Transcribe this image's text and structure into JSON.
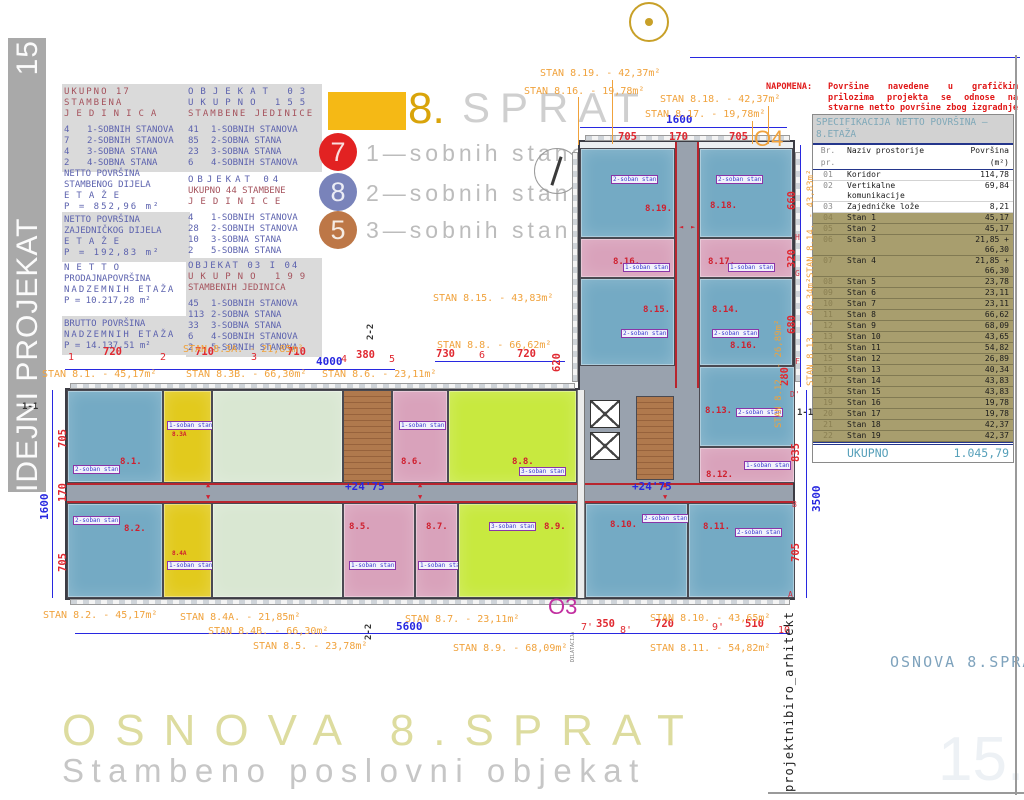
{
  "sidebar": {
    "number": "15",
    "label": "IDEJNI PROJEKAT"
  },
  "colors": {
    "apartment_blue": "#74aac4",
    "apartment_yellow": "#e2ca1d",
    "apartment_green": "#d9e7d2",
    "apartment_lime": "#c8e93f",
    "apartment_pink": "#d9a2bb",
    "stairs_brown": "#b0794d",
    "corridor_gray": "#99a2ae",
    "wall_red": "#b8252e",
    "legend_orange": "#f5b915",
    "legend_red": "#e22222",
    "legend_blue": "#7983ba",
    "legend_brown": "#bd7747",
    "label_orange": "#f0a23c",
    "dim_red": "#e02830",
    "dim_blue": "#2828e0",
    "table_olive": "#a89e6e",
    "note_red": "#e01818",
    "o3_magenta": "#c22fa0",
    "title_pale_yellow": "#dddc9f",
    "sidebar_gray": "#a9a9a9"
  },
  "stats": {
    "total": {
      "title": [
        "UKUPNO 17 STAMBENA",
        "JEDINICA"
      ],
      "items": [
        [
          "4",
          "1-SOBNIH STANOVA"
        ],
        [
          "7",
          "2-SOBNIH STANOVA"
        ],
        [
          "4",
          "3-SOBNA STANA"
        ],
        [
          "2",
          "4-SOBNA STANA"
        ]
      ]
    },
    "areas": [
      {
        "lines": [
          "NETTO POVRŠINA",
          "STAMBENOG DIJELA",
          "ETAŽE",
          "P = 852,96 m²"
        ]
      },
      {
        "lines": [
          "NETTO POVRŠINA",
          "ZAJEDNIČKOG DIJELA",
          "ETAŽE",
          "P = 192,83 m²"
        ]
      },
      {
        "lines": [
          "NETTO",
          "PRODAJNAPOVRŠINA",
          "NADZEMNIH ETAŽA",
          "P = 10.217,28 m²"
        ]
      },
      {
        "lines": [
          "BRUTTO POVRŠINA",
          "NADZEMNIH ETAŽA",
          "P = 14.137,51 m²"
        ]
      }
    ],
    "objects": [
      {
        "header": [
          "OBJEKAT 03",
          "UKUPNO 155",
          "STAMBENE JEDINICE"
        ],
        "items": [
          [
            "41",
            "1-SOBNIH STANOVA"
          ],
          [
            "85",
            "2-SOBNA STANA"
          ],
          [
            "23",
            "3-SOBNA STANA"
          ],
          [
            "6",
            "4-SOBNIH STANOVA"
          ]
        ]
      },
      {
        "header": [
          "OBJEKAT 04",
          "UKUPNO 44 STAMBENE",
          "JEDINICE"
        ],
        "items": [
          [
            "4",
            "1-SOBNIH STANOVA"
          ],
          [
            "28",
            "2-SOBNIH STANOVA"
          ],
          [
            "10",
            "3-SOBNA STANA"
          ],
          [
            "2",
            "5-SOBNA STANA"
          ]
        ]
      },
      {
        "header": [
          "OBJEKAT 03 I 04",
          "UKUPNO 199",
          "STAMBENIH JEDINICA"
        ],
        "items": [
          [
            "45",
            "1-SOBNIH STANOVA"
          ],
          [
            "113",
            "2-SOBNA STANA"
          ],
          [
            "33",
            "3-SOBNA STANA"
          ],
          [
            "6",
            "4-SOBNIH STANOVA"
          ],
          [
            "2",
            "5-SOBNIH STANOVA"
          ]
        ]
      }
    ]
  },
  "legend": {
    "floor_number": "8.",
    "floor_word": "SPRAT",
    "entries": [
      {
        "count": "7",
        "label": "1—sobnih stanova",
        "color": "#e22222"
      },
      {
        "count": "8",
        "label": "2—sobnih stanova",
        "color": "#7983ba"
      },
      {
        "count": "5",
        "label": "3—sobnih stanova",
        "color": "#bd7747"
      }
    ]
  },
  "napomena": {
    "label": "NAPOMENA:",
    "text": "Površine navedene u grafičkim prilozima projekta se odnose na stvarne netto površine zbog izgradnje objekta."
  },
  "spec_table": {
    "title_line1": "SPECIFIKACIJA NETTO POVRŠINA —",
    "title_line2": "8.ETAŽA",
    "columns": [
      "Br. pr.",
      "Naziv prostorije",
      "Površina (m²)"
    ],
    "rows": [
      [
        "01",
        "Koridor",
        "114,78"
      ],
      [
        "02",
        "Vertikalne komunikacije",
        "69,84"
      ],
      [
        "03",
        "Zajedničke lože",
        "8,21"
      ],
      [
        "04",
        "Stan 1",
        "45,17"
      ],
      [
        "05",
        "Stan 2",
        "45,17"
      ],
      [
        "06",
        "Stan 3",
        "21,85 + 66,30"
      ],
      [
        "07",
        "Stan 4",
        "21,85 + 66,30"
      ],
      [
        "08",
        "Stan 5",
        "23,78"
      ],
      [
        "09",
        "Stan 6",
        "23,11"
      ],
      [
        "10",
        "Stan 7",
        "23,11"
      ],
      [
        "11",
        "Stan 8",
        "66,62"
      ],
      [
        "12",
        "Stan 9",
        "68,09"
      ],
      [
        "13",
        "Stan 10",
        "43,65"
      ],
      [
        "14",
        "Stan 11",
        "54,82"
      ],
      [
        "15",
        "Stan 12",
        "26,89"
      ],
      [
        "16",
        "Stan 13",
        "40,34"
      ],
      [
        "17",
        "Stan 14",
        "43,83"
      ],
      [
        "18",
        "Stan 15",
        "43,83"
      ],
      [
        "19",
        "Stan 16",
        "19,78"
      ],
      [
        "20",
        "Stan 17",
        "19,78"
      ],
      [
        "21",
        "Stan 18",
        "42,37"
      ],
      [
        "22",
        "Stan 19",
        "42,37"
      ]
    ],
    "total_label": "UKUPNO",
    "total_value": "1.045,79"
  },
  "plan": {
    "apartments": [
      {
        "id": "8.1.",
        "tag": "2-soban stan"
      },
      {
        "id": "8.2.",
        "tag": "2-soban stan"
      },
      {
        "id": "8.3A",
        "tag": "1-soban stan"
      },
      {
        "id": "8.4A",
        "tag": "1-soban stan"
      },
      {
        "id": "8.5.",
        "tag": "1-soban stan"
      },
      {
        "id": "8.6.",
        "tag": "1-soban stan"
      },
      {
        "id": "8.7.",
        "tag": "1-soban stan"
      },
      {
        "id": "8.8.",
        "tag": "3-soban stan"
      },
      {
        "id": "8.9.",
        "tag": "3-soban stan"
      },
      {
        "id": "8.10.",
        "tag": "2-soban stan"
      },
      {
        "id": "8.11.",
        "tag": "2-soban stan"
      },
      {
        "id": "8.12.",
        "tag": "1-soban stan"
      },
      {
        "id": "8.13.",
        "tag": "2-soban stan"
      },
      {
        "id": "8.14.",
        "tag": "2-soban stan"
      },
      {
        "id": "8.15.",
        "tag": "2-soban stan"
      },
      {
        "id": "8.16.",
        "tag": "1-soban stan"
      },
      {
        "id": "8.17.",
        "tag": "1-soban stan"
      },
      {
        "id": "8.18.",
        "tag": "2-soban stan"
      },
      {
        "id": "8.19.",
        "tag": "2-soban stan"
      }
    ],
    "stray_label": "8.16.",
    "stan_labels": [
      "STAN 8.19. - 42,37m²",
      "STAN 8.16. - 19,78m²",
      "STAN 8.18. - 42,37m²",
      "STAN 8.17. - 19,78m²",
      "STAN 8.15. - 43,83m²",
      "STAN 8.8. - 66,62m²",
      "STAN 8.3A. - 21,85m²",
      "STAN 8.1. - 45,17m²",
      "STAN 8.3B. - 66,30m²",
      "STAN 8.6. - 23,11m²",
      "STAN 8.2. - 45,17m²",
      "STAN 8.4A. - 21,85m²",
      "STAN 8.4B. - 66,30m²",
      "STAN 8.5. - 23,78m²",
      "STAN 8.7. - 23,11m²",
      "STAN 8.9. - 68,09m²",
      "STAN 8.10. - 43,65m²",
      "STAN 8.11. - 54,82m²",
      "STAN 8.14. - 43,83m²",
      "STAN 8.13. - 40,34m²",
      "STAN 8.12. - 26,89m²"
    ],
    "dims": {
      "top_total": "1600",
      "top_parts": [
        "705",
        "170",
        "705"
      ],
      "row": [
        "720",
        "710",
        "710",
        "380"
      ],
      "overall_top": "4000",
      "mid": [
        "730",
        "720"
      ],
      "mid_vert": "620",
      "left_total": "1600",
      "left_parts": [
        "705",
        "170",
        "705"
      ],
      "bottom_total": "5600",
      "bottom_parts": [
        "350",
        "720",
        "510"
      ],
      "right_wing": [
        "660",
        "320",
        "680",
        "280"
      ],
      "right_lower": [
        "835",
        "705"
      ],
      "right_total": "3500"
    },
    "grid": {
      "top": [
        "1",
        "2",
        "3",
        "4",
        "5",
        "6"
      ],
      "bottom": [
        "7'",
        "8'",
        "9'",
        "10"
      ],
      "letters": [
        "H",
        "G",
        "F",
        "D'",
        "B",
        "A"
      ]
    },
    "markers": {
      "o3": "O3",
      "o4": "O4",
      "dilatacija": "DILATACIJA",
      "section_a": "1-1",
      "section_b": "2-2",
      "level": "+24'75"
    }
  },
  "footer": {
    "big_title": "OSNOVA 8.SPRAT",
    "subtitle": "Stambeno poslovni objekat",
    "credit": "projektnibiro_arhitekt",
    "drawing_name": "OSNOVA 8.SPRAT",
    "watermark": "15."
  }
}
